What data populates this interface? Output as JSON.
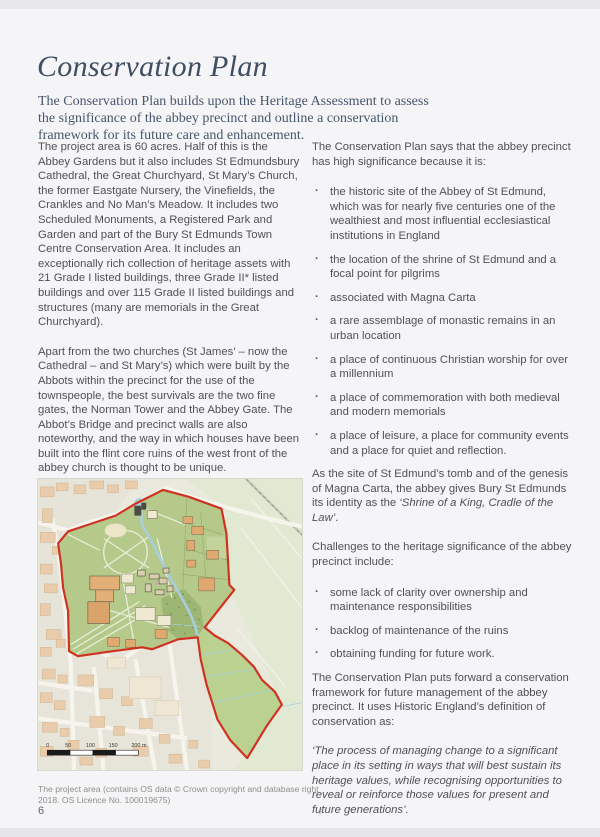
{
  "page": {
    "title": "Conservation Plan",
    "title_color": "#3f4e63",
    "intro_color": "#46566c",
    "intro": "The Conservation Plan builds upon the Heritage Assessment to assess the significance of the abbey precinct and outline a conservation framework for its future care and enhancement.",
    "page_number": "6"
  },
  "left_column": {
    "para1": "The project area is 60 acres. Half of this is the Abbey Gardens but it also includes St Edmundsbury Cathedral, the Great Churchyard, St Mary’s Church, the former Eastgate Nursery, the Vinefields, the Crankles and No Man’s Meadow. It includes two Scheduled Monuments, a Registered Park and Garden and part of the Bury St Edmunds Town Centre Conservation Area. It includes an exceptionally rich collection of heritage assets with 21 Grade I listed buildings, three Grade II* listed buildings and over 115 Grade II listed buildings and structures (many are memorials in the Great Churchyard).",
    "para2": "Apart from the two churches (St James’ – now the Cathedral – and St Mary’s) which were built by the Abbots within the precinct for the use of the townspeople, the best survivals are the two fine gates, the Norman Tower and the Abbey Gate. The Abbot’s Bridge and precinct walls are also noteworthy, and the way in which houses have been built into the flint core ruins of the west front of the abbey church is thought to be unique."
  },
  "right_column": {
    "significance_intro": "The Conservation Plan says that the abbey precinct has high significance because it is:",
    "significance_bullets": [
      "the historic site of the Abbey of St Edmund, which was for nearly five centuries one of the wealthiest and most influential ecclesiastical institutions in England",
      "the location of the shrine of St Edmund and a focal point for pilgrims",
      "associated with Magna Carta",
      "a rare assemblage of monastic remains in an urban location",
      "a place of continuous Christian worship for over a millennium",
      "a place of commemoration with both medieval and modern memorials",
      "a place of leisure, a place for community events and a place for quiet and reflection."
    ],
    "identity_prefix": "As the site of St Edmund’s tomb and of the genesis of Magna Carta, the abbey gives Bury St Edmunds its identity as the ",
    "identity_italic": "‘Shrine of a King, Cradle of the Law’",
    "identity_suffix": ".",
    "challenges_intro": "Challenges to the heritage significance of the abbey precinct include:",
    "challenges_bullets": [
      "some lack of clarity over ownership and maintenance responsibilities",
      "backlog of maintenance of the ruins",
      "obtaining funding for future work."
    ],
    "framework_para": "The Conservation Plan puts forward a conservation framework for future management of the abbey precinct. It uses Historic England’s definition of conservation as:",
    "quote": "‘The process of managing change to a significant place in its setting in ways that will best sustain its heritage values, while recognising opportunities to reveal or reinforce those values for present and future generations’."
  },
  "map": {
    "caption": "The project area (contains OS data © Crown copyright and database right 2018. OS Licence No. 100019675)",
    "scale_labels": [
      "0",
      "50",
      "100",
      "150",
      "200 m"
    ],
    "boundary_color": "#d03222",
    "precinct_green": "#b4c98a",
    "meadow_green": "#bad190",
    "trees_green": "#9db674",
    "river_blue": "#a9cede"
  }
}
